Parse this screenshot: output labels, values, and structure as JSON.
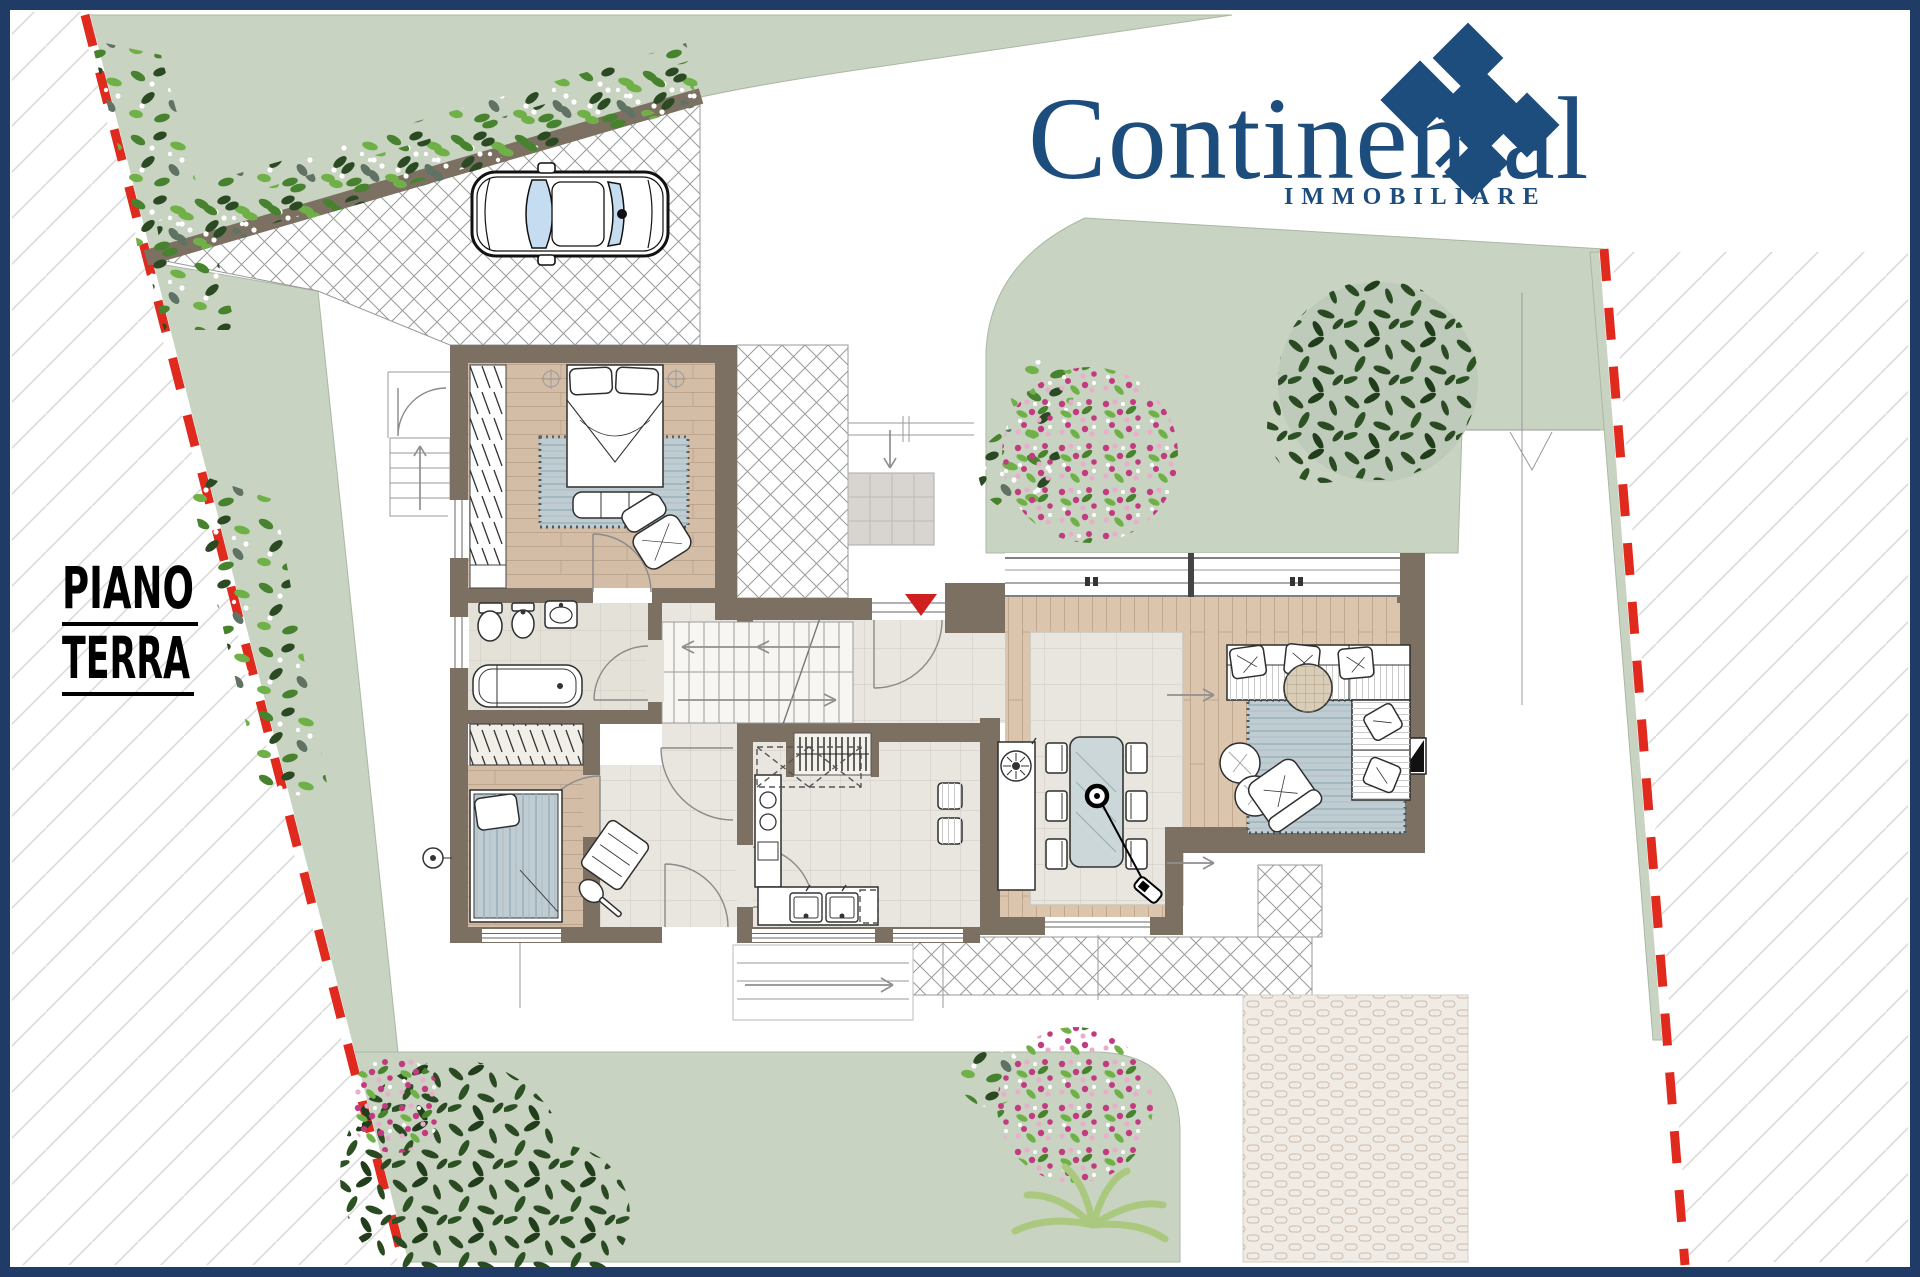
{
  "title": {
    "line1": "PIANO",
    "line2": "TERRA"
  },
  "logo": {
    "brand": "Continental",
    "subtitle": "IMMOBILIARE"
  },
  "legend": {
    "site_elements": [
      "property-boundary-red-white",
      "adjacent-lot-hatching",
      "garden-lawn",
      "hedge-row",
      "large-tree",
      "flowering-bush-pink",
      "flowering-bush-white",
      "fern-plant",
      "driveway-paving",
      "entrance-path",
      "terrace-paving",
      "cobble-paving",
      "parked-car",
      "exterior-stair",
      "lot-survey-lines"
    ],
    "rooms": [
      "bedroom-1",
      "bathroom",
      "bedroom-2",
      "corridor",
      "entry-hall",
      "staircase",
      "kitchen",
      "dining-area",
      "living-room"
    ],
    "furniture": [
      "double-bed",
      "wardrobe",
      "bedroom-armchair",
      "bedroom-rug",
      "foot-bench",
      "toilet",
      "bidet",
      "washbasin",
      "bathtub",
      "single-bed",
      "tilted-chair",
      "closet-shelving",
      "kitchen-tall-unit",
      "kitchen-counter-double-sink",
      "wall-cabinets-dashed",
      "bar-stools",
      "peninsula-cooktop",
      "dining-table-glass",
      "dining-chairs",
      "pendant-lamp",
      "corner-sofa",
      "sofa-cushions",
      "living-rug",
      "round-side-table",
      "poufs",
      "lounge-armchair",
      "fireplace-niche",
      "entrance-marker-triangle",
      "ceiling-light-symbols"
    ]
  },
  "colors": {
    "navy": "#1f3b66",
    "logoNavy": "#1d4d7c",
    "sage": "#c8d3c2",
    "sageEdge": "#aab8a4",
    "wall": "#7b7061",
    "red": "#cf1f1f",
    "boundaryRed": "#e02a1e",
    "woodA": "#d4bda6",
    "woodB": "#dbc5ad",
    "woodLine": "#b79d84",
    "tileBg": "#e9e6e0",
    "tileLine": "#cfcbc2",
    "bathTile": "#e4e1d9",
    "rugBlue": "#bfccd2",
    "rugLine": "#9cb1ba",
    "lattice": "#979c98",
    "hatchThin": "#dadada",
    "leafDark": "#2b4a23",
    "leafMid": "#47822f",
    "leafLight": "#6fb148",
    "leafGray": "#5f7263",
    "flowerPink": "#c23a80",
    "flowerSoft": "#e9aecb",
    "fern": "#abc97e",
    "cobbleBg": "#f0ebe5",
    "cobbleLine": "#cdbbac",
    "glass": "#c6ddf1",
    "grayLine": "#9a9a9a",
    "ink": "#2e2e2e",
    "padGray": "#d8d5d0"
  }
}
